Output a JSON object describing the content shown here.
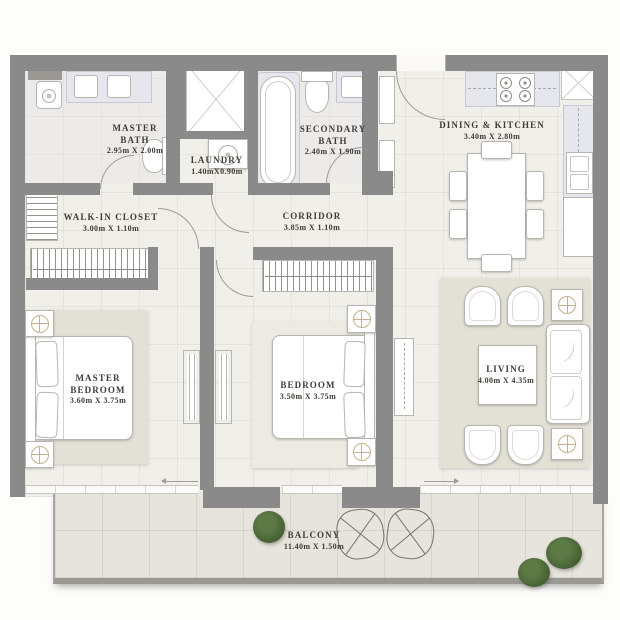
{
  "rooms": {
    "master_bath": {
      "name": "MASTER BATH",
      "dims": "2.95m X 2.00m"
    },
    "laundry": {
      "name": "LAUNDRY",
      "dims": "1.40mX0.90m"
    },
    "secondary_bath": {
      "name": "SECONDARY BATH",
      "dims": "2.40m X 1.90m"
    },
    "dining_kitchen": {
      "name": "DINING & KITCHEN",
      "dims": "3.40m X 2.80m"
    },
    "walk_in_closet": {
      "name": "WALK-IN CLOSET",
      "dims": "3.00m X 1.10m"
    },
    "corridor": {
      "name": "CORRIDOR",
      "dims": "3.85m X 1.10m"
    },
    "master_bedroom": {
      "name": "MASTER BEDROOM",
      "dims": "3.60m X 3.75m"
    },
    "bedroom": {
      "name": "BEDROOM",
      "dims": "3.50m X 3.75m"
    },
    "living": {
      "name": "LIVING",
      "dims": "4.00m X 4.35m"
    },
    "balcony": {
      "name": "BALCONY",
      "dims": "11.40m X 1.50m"
    }
  },
  "colors": {
    "wall": "#8a8a8a",
    "floor": "#f1efe9",
    "balcony": "#e6e4dd",
    "rug": "#e3e0d6",
    "marble": "#e6e6ed",
    "label": "#3e3d38",
    "plant": "#466033",
    "tan": "#c2b28c"
  }
}
